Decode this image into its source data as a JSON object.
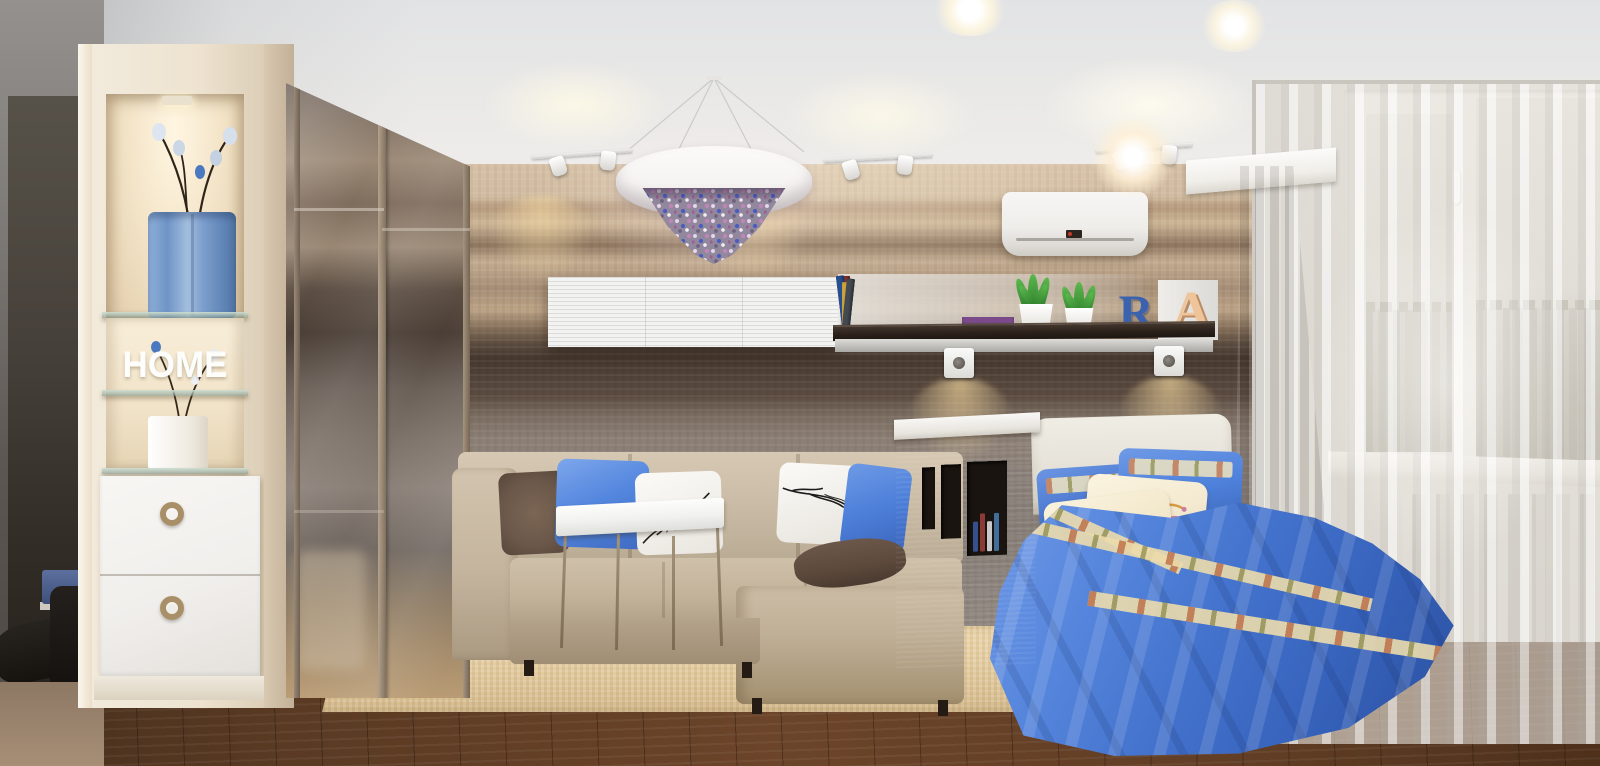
{
  "scene": {
    "description": "3D interior render of a studio apartment combining living room and bedroom: beige sectional sofa, blue-dressed bed behind a cubby half-wall, striped wood feature wall, crystal drum chandelier, sheer-curtained window with city view",
    "decor_text": {
      "home_sign": "HOME",
      "letter_r": "R",
      "letter_a": "A"
    },
    "palette": {
      "ceiling": "#f0efed",
      "wall_wood_light": "#d2bda2",
      "wall_wood_dark": "#46382f",
      "wall_grey_taupe": "#8d8076",
      "sofa_beige": "#c7b8a2",
      "rug_beige": "#e3cba0",
      "floor_brown": "#5e3c24",
      "bed_blue": "#4372cc",
      "pillow_blue": "#4f82dc",
      "pillow_brown": "#6b584a",
      "pillow_cream_floral": "#f3e9cf",
      "letter_r_blue": "#3a62ae",
      "letter_a_peach": "#efc49a",
      "vase_blue": "#7d9fce",
      "drape_grey": "#958e83",
      "sheer_white": "#eeebe5",
      "chandelier_crystals": [
        "#e7d7ea",
        "#4a5cc0",
        "#c285b8",
        "#6d6480",
        "#f3eef5"
      ]
    },
    "shelf": {
      "books": [
        "#2b4a8a",
        "#c23b2e",
        "#1f1f1f",
        "#2e8b8b",
        "#d9c05a",
        "#7a2d8a",
        "#e0e0e0",
        "#3a7a3a",
        "#8a2d2d",
        "#24508f",
        "#caa13c",
        "#444a52"
      ],
      "stack": [
        "#b03a2e",
        "#caa43c",
        "#3a62a0",
        "#7a4a8a"
      ],
      "niche_books": [
        "#35508c",
        "#8c3a35",
        "#c9c9c9",
        "#3f6f9a"
      ]
    },
    "objects": [
      "display-unit-with-home-letters",
      "blue-vase-with-branches",
      "drawer-unit",
      "hallway-mirror",
      "boots",
      "mirrored-wardrobe",
      "striped-wood-wall",
      "crystal-drum-chandelier",
      "track-spotlights",
      "recessed-ceiling-lights",
      "air-conditioner",
      "floating-white-cabinet",
      "dark-wall-shelf",
      "succulent-pots",
      "decor-letters-R-A",
      "wall-spotlights",
      "sectional-sofa",
      "branch-print-pillows",
      "coffee-table",
      "shag-rug",
      "cubby-partition-wall",
      "bed-with-blue-duvet",
      "floral-cream-pillows",
      "headboard",
      "cornice-box",
      "grey-drape",
      "sheer-curtains",
      "window-city-view",
      "radiator",
      "wood-floor"
    ]
  }
}
